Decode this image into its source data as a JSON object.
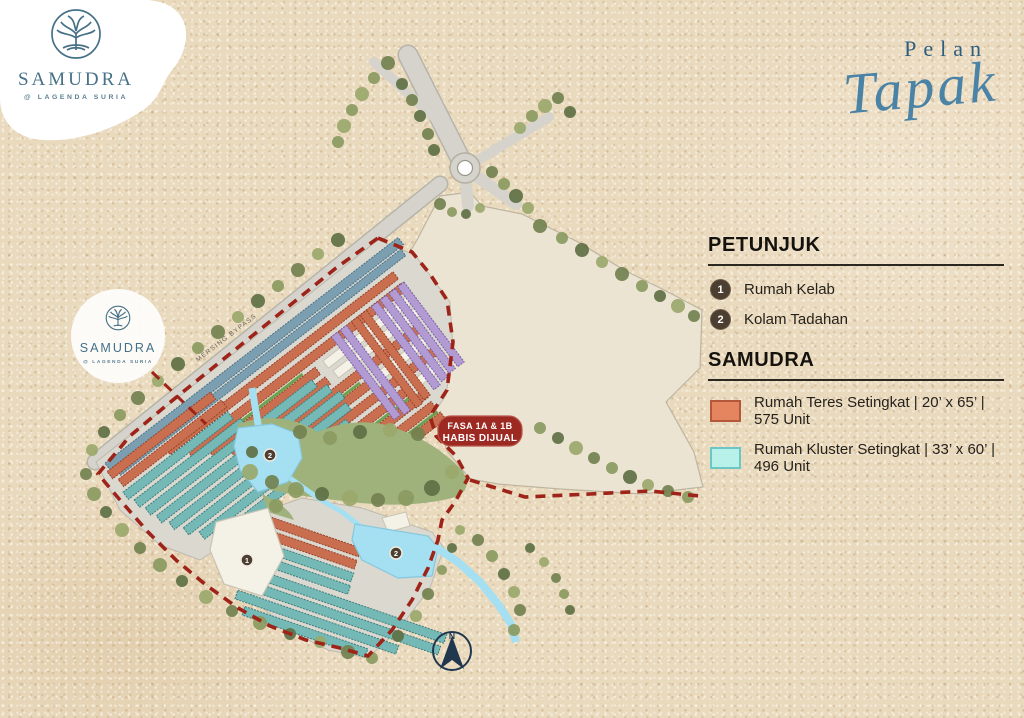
{
  "brand": {
    "name": "SAMUDRA",
    "tagline": "@ LAGENDA SURIA"
  },
  "title": {
    "pre": "Pelan",
    "main": "Tapak"
  },
  "map": {
    "road_label": "MERSING BYPASS",
    "badge_line1": "FASA 1A & 1B",
    "badge_line2": "HABIS DIJUAL",
    "north": "N",
    "marker1": "1",
    "marker2": "2"
  },
  "legend": {
    "petunjuk": "PETUNJUK",
    "items": [
      {
        "num": "1",
        "label": "Rumah Kelab"
      },
      {
        "num": "2",
        "label": "Kolam Tadahan"
      }
    ],
    "samudra": "SAMUDRA",
    "types": [
      {
        "color": "#E4855F",
        "label": "Rumah Teres Setingkat | 20’ x 65’ | 575 Unit"
      },
      {
        "color": "#B7F1E9",
        "label": "Rumah Kluster Setingkat | 33’ x 60’ | 496 Unit"
      }
    ]
  },
  "colors": {
    "boundary_red": "#9E2318",
    "badge_red": "#9C2A22",
    "brand_teal": "#467187",
    "water": "#A5DFF2"
  }
}
